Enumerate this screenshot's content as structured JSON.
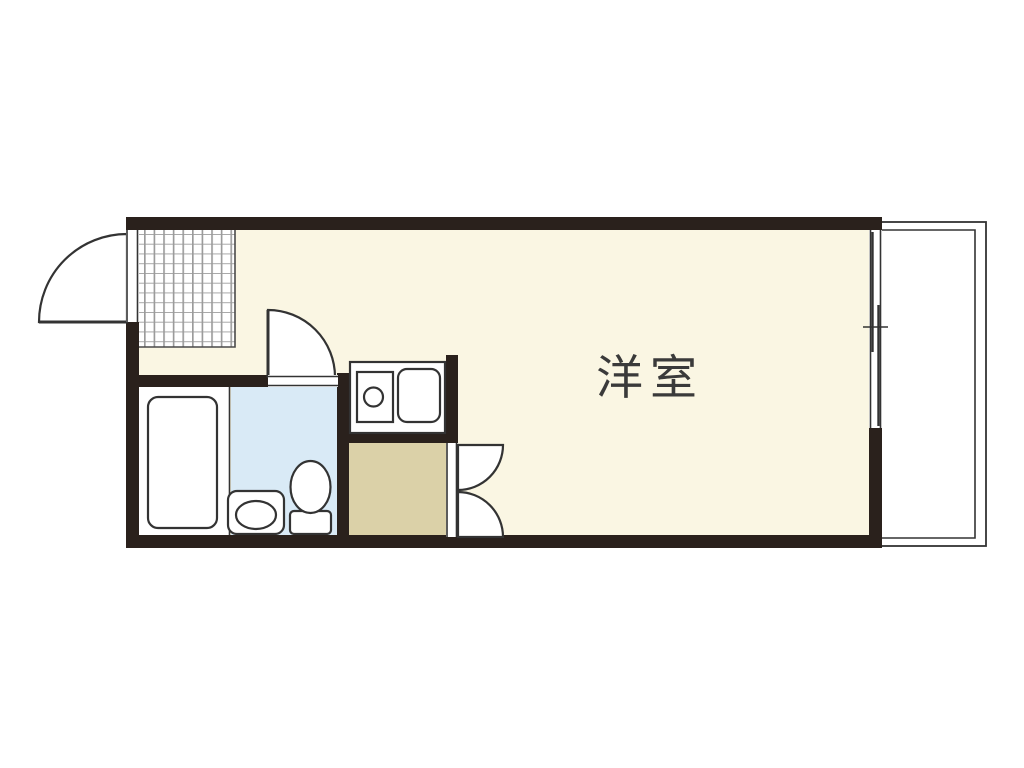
{
  "plan": {
    "room_label": "洋室",
    "colors": {
      "bg": "#ffffff",
      "wall": "#2a211c",
      "floor_main": "#faf6e3",
      "floor_bath": "#ffffff",
      "floor_wash": "#d9eaf6",
      "floor_closet": "#dbd1a8",
      "line": "#333333",
      "line_soft": "#5a5a5a",
      "grid_line": "#9b9b9b",
      "label": "#3a3a3a"
    }
  }
}
